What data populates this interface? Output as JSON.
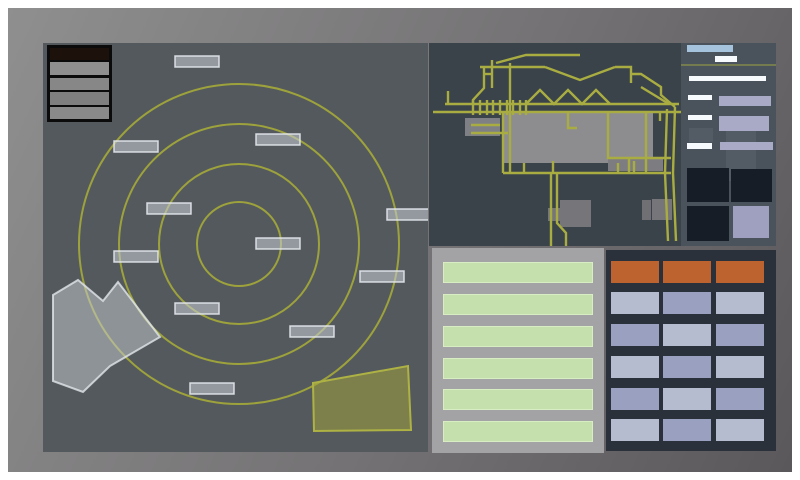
{
  "app": {
    "title": "tactical-console"
  },
  "colors": {
    "frame_light": "#8f8f8f",
    "frame_dark": "#5a585a",
    "radar_bg": "#54595d",
    "map_bg": "#3a424a",
    "control_bg": "#4a525b",
    "status_bg": "#a3a3a6",
    "keypad_bg": "#2b313a",
    "ring": "#9da23c",
    "road": "#a9ad41",
    "blip_fill": "rgba(199,205,211,0.55)",
    "blip_stroke": "rgba(228,233,238,0.9)",
    "gray_zone_fill": "rgba(200,206,212,0.5)",
    "gray_zone_stroke": "rgba(226,231,236,0.8)",
    "olive_zone_fill": "rgba(158,160,60,0.55)",
    "olive_zone_stroke": "#aeb244",
    "green_row": "#c6e0ad",
    "orange": "#bd6330",
    "light": "#b6bccf",
    "mid": "#9aa0c0",
    "white_bar": "#f7fafc",
    "lavender": "#a9aac6",
    "tile_dark": "#161d26",
    "tile_active": "#9fa0bf",
    "title_blue": "#a5c3dc"
  },
  "legend": {
    "rows": [
      {
        "name": "legend-title-row",
        "y": 3,
        "h": 12,
        "color": "#1c120b"
      },
      {
        "name": "legend-bar",
        "y": 17,
        "h": 13,
        "color": "#8f8f8f"
      },
      {
        "name": "legend-bar",
        "y": 33,
        "h": 12,
        "color": "#878787"
      },
      {
        "name": "legend-bar",
        "y": 47,
        "h": 13,
        "color": "#7f7f7f"
      },
      {
        "name": "legend-bar",
        "y": 62,
        "h": 12,
        "color": "#8a8a8a"
      }
    ]
  },
  "radar": {
    "center": {
      "x": 196,
      "y": 201
    },
    "ring_radii": [
      42,
      80,
      120,
      160
    ],
    "blips": [
      {
        "x": 132,
        "y": 13
      },
      {
        "x": 71,
        "y": 98
      },
      {
        "x": 213,
        "y": 91
      },
      {
        "x": 104,
        "y": 160
      },
      {
        "x": 344,
        "y": 166
      },
      {
        "x": 213,
        "y": 195
      },
      {
        "x": 317,
        "y": 228
      },
      {
        "x": 132,
        "y": 260
      },
      {
        "x": 247,
        "y": 283
      },
      {
        "x": 71,
        "y": 208
      },
      {
        "x": 147,
        "y": 340
      }
    ],
    "blip_size": {
      "w": 44,
      "h": 11
    },
    "gray_zone_points": "10,252 35,237 60,258 75,239 117,294 67,323 40,349 10,338",
    "olive_zone_points": "270,340 365,323 368,387 271,388"
  },
  "map": {
    "blocks": [
      {
        "x": 36,
        "y": 75,
        "w": 35,
        "h": 18,
        "color": "#7e8086"
      },
      {
        "x": 74,
        "y": 70,
        "w": 150,
        "h": 50,
        "color": "#8d8d90"
      },
      {
        "x": 179,
        "y": 115,
        "w": 55,
        "h": 13,
        "color": "#7d7d81"
      },
      {
        "x": 119,
        "y": 165,
        "w": 12,
        "h": 13,
        "color": "#75757a"
      },
      {
        "x": 131,
        "y": 157,
        "w": 31,
        "h": 27,
        "color": "#75757a"
      },
      {
        "x": 213,
        "y": 157,
        "w": 9,
        "h": 20,
        "color": "#6f6f74"
      },
      {
        "x": 223,
        "y": 156,
        "w": 20,
        "h": 21,
        "color": "#75757a"
      }
    ],
    "roads": [
      "M16 61 H250",
      "M4 69 H268",
      "M44 57 V72",
      "M51 57 V72",
      "M58 57 V72",
      "M64 57 V72",
      "M71 57 V72",
      "M78 57 V72",
      "M84 57 V72",
      "M91 57 V72",
      "M97 57 V72",
      "M97 61 L111 47 L125 61 L139 47 L153 61 L167 47 L181 61",
      "M51 24 H116",
      "M116 24 L151 37 L186 24",
      "M186 24 H202 V40",
      "M67 20 L97 12 H151",
      "M55 24 V45 L44 57 V61",
      "M63 17 V45",
      "M55 31 H63",
      "M81 20 V130",
      "M74 70 V130",
      "M19 61 V48",
      "M74 130 H242",
      "M95 130 V120",
      "M124 130 V118",
      "M189 130 V120",
      "M205 130 V118",
      "M122 130 V203",
      "M128 130 V180 L137 190 V203",
      "M42 82 H71",
      "M42 90 H79",
      "M139 70 V85 H148",
      "M179 70 V115 H242",
      "M200 115 V130",
      "M217 70 V130",
      "M231 70 V78",
      "M202 31 H212 L232 44 V52 L246 64",
      "M212 44 L240 61",
      "M246 64 L244 130 L247 198",
      "M238 66 L236 130 L239 198"
    ]
  },
  "control": {
    "line_y": 21,
    "ghosts": [
      {
        "x": 8,
        "y": 85,
        "w": 24,
        "h": 14
      },
      {
        "x": 45,
        "y": 83,
        "w": 30,
        "h": 55
      }
    ],
    "items": [
      {
        "name": "panel-title-bar",
        "x": 6,
        "y": 2,
        "w": 46,
        "h": 7,
        "color": "#a5c3dc",
        "interactable": false
      },
      {
        "name": "panel-subtitle-chip",
        "x": 34,
        "y": 13,
        "w": 22,
        "h": 6,
        "color": "#f7fafc",
        "interactable": false
      },
      {
        "name": "readout-bar",
        "x": 8,
        "y": 33,
        "w": 77,
        "h": 5,
        "color": "#f7fafc",
        "interactable": false
      },
      {
        "name": "field-label",
        "x": 7,
        "y": 52,
        "w": 24,
        "h": 5,
        "color": "#f7fafc",
        "interactable": false
      },
      {
        "name": "field-value-button",
        "x": 38,
        "y": 53,
        "w": 52,
        "h": 10,
        "color": "#a9aac6",
        "interactable": true
      },
      {
        "name": "field-label",
        "x": 7,
        "y": 72,
        "w": 24,
        "h": 5,
        "color": "#f7fafc",
        "interactable": false
      },
      {
        "name": "field-value-button",
        "x": 38,
        "y": 73,
        "w": 50,
        "h": 15,
        "color": "#a9aac6",
        "interactable": true
      },
      {
        "name": "field-label",
        "x": 6,
        "y": 100,
        "w": 25,
        "h": 6,
        "color": "#f7fafc",
        "interactable": false
      },
      {
        "name": "field-value-button",
        "x": 39,
        "y": 99,
        "w": 53,
        "h": 8,
        "color": "#a9aac6",
        "interactable": true
      },
      {
        "name": "display-tile",
        "x": 6,
        "y": 125,
        "w": 42,
        "h": 34,
        "color": "#161d26",
        "interactable": true
      },
      {
        "name": "display-tile",
        "x": 50,
        "y": 126,
        "w": 41,
        "h": 33,
        "color": "#161d26",
        "interactable": true
      },
      {
        "name": "display-tile",
        "x": 6,
        "y": 163,
        "w": 42,
        "h": 35,
        "color": "#161d26",
        "interactable": true
      },
      {
        "name": "display-tile-active",
        "x": 52,
        "y": 163,
        "w": 36,
        "h": 32,
        "color": "#9fa0bf",
        "interactable": true
      }
    ]
  },
  "status_list": {
    "row_tops": [
      14,
      46,
      78,
      110,
      141,
      173
    ],
    "row_count": 6
  },
  "keypad": {
    "col_x": [
      5,
      57,
      110
    ],
    "col_w": 48,
    "row_h": 22,
    "rows": [
      {
        "y": 11,
        "cells": [
          "orange",
          "orange",
          "orange"
        ]
      },
      {
        "y": 42,
        "cells": [
          "light",
          "mid",
          "light"
        ]
      },
      {
        "y": 74,
        "cells": [
          "mid",
          "light",
          "mid"
        ]
      },
      {
        "y": 106,
        "cells": [
          "light",
          "mid",
          "light"
        ]
      },
      {
        "y": 138,
        "cells": [
          "mid",
          "light",
          "mid"
        ]
      },
      {
        "y": 169,
        "cells": [
          "light",
          "mid",
          "light"
        ]
      }
    ]
  }
}
